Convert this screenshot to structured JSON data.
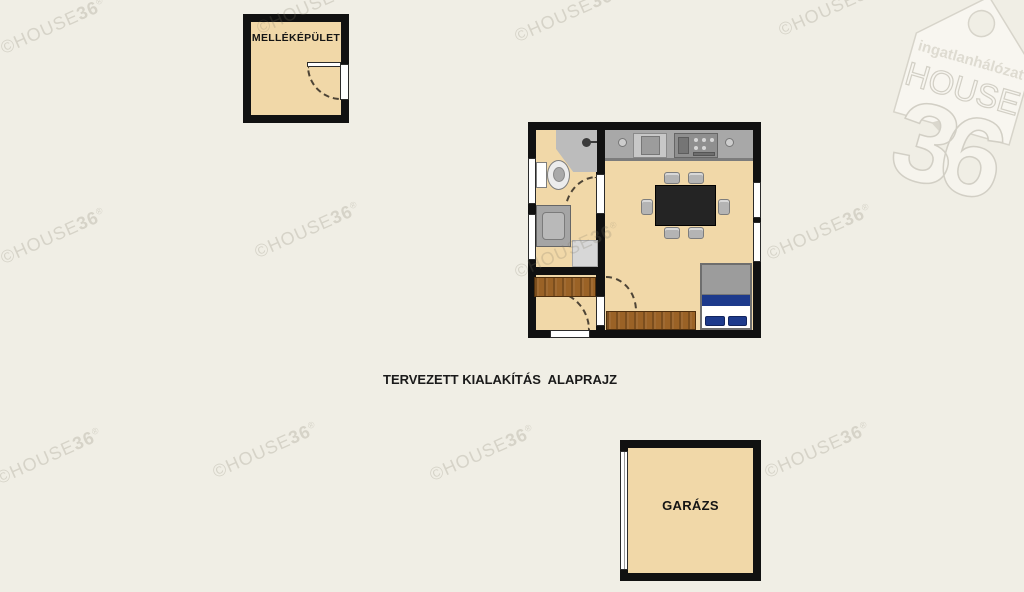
{
  "title": "TERVEZETT KIALAKÍTÁS  ALAPRAJZ",
  "labels": {
    "outbuilding": "MELLÉKÉPÜLET",
    "garage": "GARÁZS"
  },
  "watermark": {
    "prefix": "©HOUSE",
    "suffix": "36",
    "reg": "®"
  },
  "logo": {
    "network": "ingatlanhálózat",
    "brand": "HOUSE",
    "number": "36"
  },
  "colors": {
    "background": "#f0eee5",
    "floor": "#f1d8a8",
    "wall": "#111111",
    "wood": "#9a6226",
    "bed_navy": "#1d3a8c",
    "counter_gray": "#a8a8a8",
    "table_dark": "#242424",
    "watermark_gray": "#d8d5cb"
  }
}
